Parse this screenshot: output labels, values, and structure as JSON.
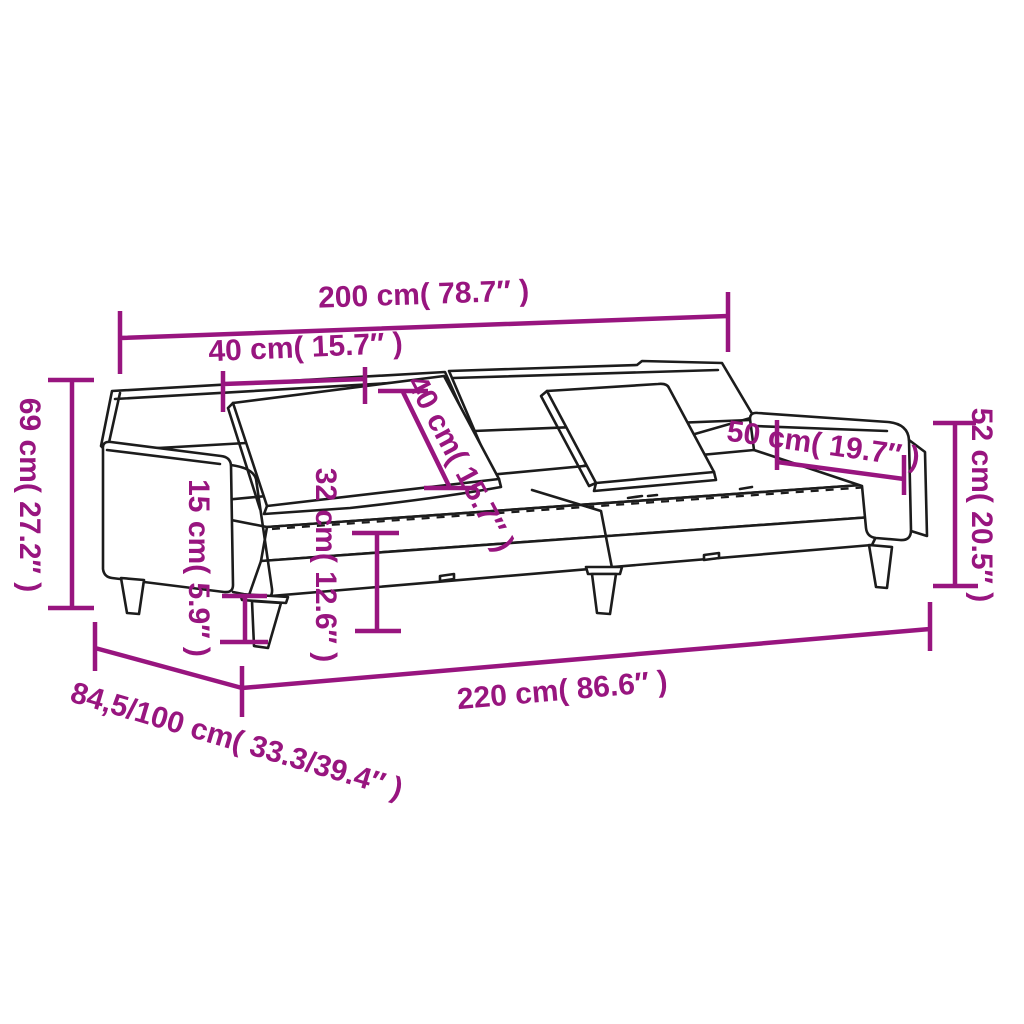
{
  "diagram": {
    "title": "Sofa bed with pillows - dimension diagram",
    "background": "#FFFFFF",
    "accent_color": "#98157F",
    "outline_color": "#1C1C1C",
    "dims": {
      "back_width": {
        "cm": "200",
        "inch": "78.7",
        "label": "200 cm( 78.7″ )"
      },
      "cushion_width": {
        "cm": "40",
        "inch": "15.7",
        "label": "40 cm( 15.7″ )"
      },
      "cushion_height": {
        "cm": "40",
        "inch": "15.7",
        "label": "40 cm( 15.7″ )"
      },
      "total_height": {
        "cm": "69",
        "inch": "27.2",
        "label": "69 cm( 27.2″ )"
      },
      "leg_height": {
        "cm": "15",
        "inch": "5.9",
        "label": "15 cm( 5.9″ )"
      },
      "seat_height": {
        "cm": "32",
        "inch": "12.6",
        "label": "32 cm( 12.6″ )"
      },
      "armrest_length": {
        "cm": "50",
        "inch": "19.7",
        "label": "50 cm( 19.7″ )"
      },
      "armrest_height": {
        "cm": "52",
        "inch": "20.5",
        "label": "52 cm( 20.5″ )"
      },
      "total_length": {
        "cm": "220",
        "inch": "86.6",
        "label": "220 cm( 86.6″ )"
      },
      "depth": {
        "cm": "84,5/100",
        "inch": "33.3/39.4",
        "label": "84,5/100 cm( 33.3/39.4″ )"
      }
    }
  }
}
